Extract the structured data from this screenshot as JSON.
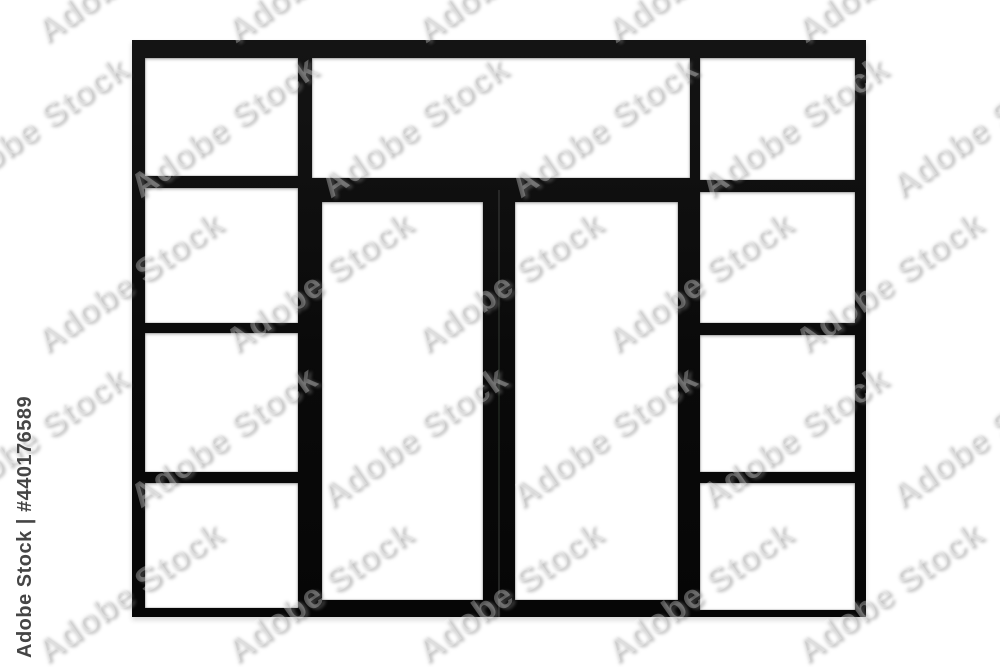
{
  "watermark": {
    "tile_text": "Adobe Stock",
    "id_text": "Adobe Stock | #440176589",
    "id_number": "#440176589"
  },
  "colors": {
    "background": "#ffffff",
    "frame": "#0c0c0c",
    "glass": "#ffffff",
    "watermark_id_text": "#454545",
    "watermark_tile_shadow": "#7d7d7d"
  }
}
